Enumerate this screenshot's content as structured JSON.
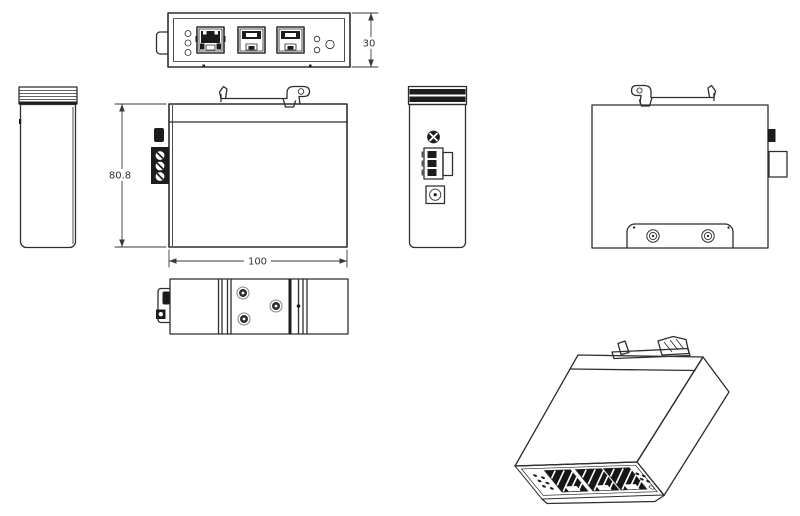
{
  "drawing": {
    "background_color": "#ffffff",
    "line_color": "#2e2e2e",
    "dimensions": {
      "panel_height_mm": "30",
      "body_depth_mm": "80.8",
      "body_width_mm": "100"
    },
    "views": {
      "top": "front-panel-view",
      "left": "left-side-view",
      "front": "front-view-with-din-clip",
      "power_side": "right-side-power-view",
      "rear": "rear-din-mount-view",
      "bottom": "bottom-view",
      "isometric": "isometric-view"
    },
    "features": {
      "ethernet_ports": 3,
      "status_leds_left": 3,
      "status_leds_right": 2,
      "terminal_screws": 3,
      "rear_plate_screws": 2,
      "bottom_screws": 3
    }
  }
}
